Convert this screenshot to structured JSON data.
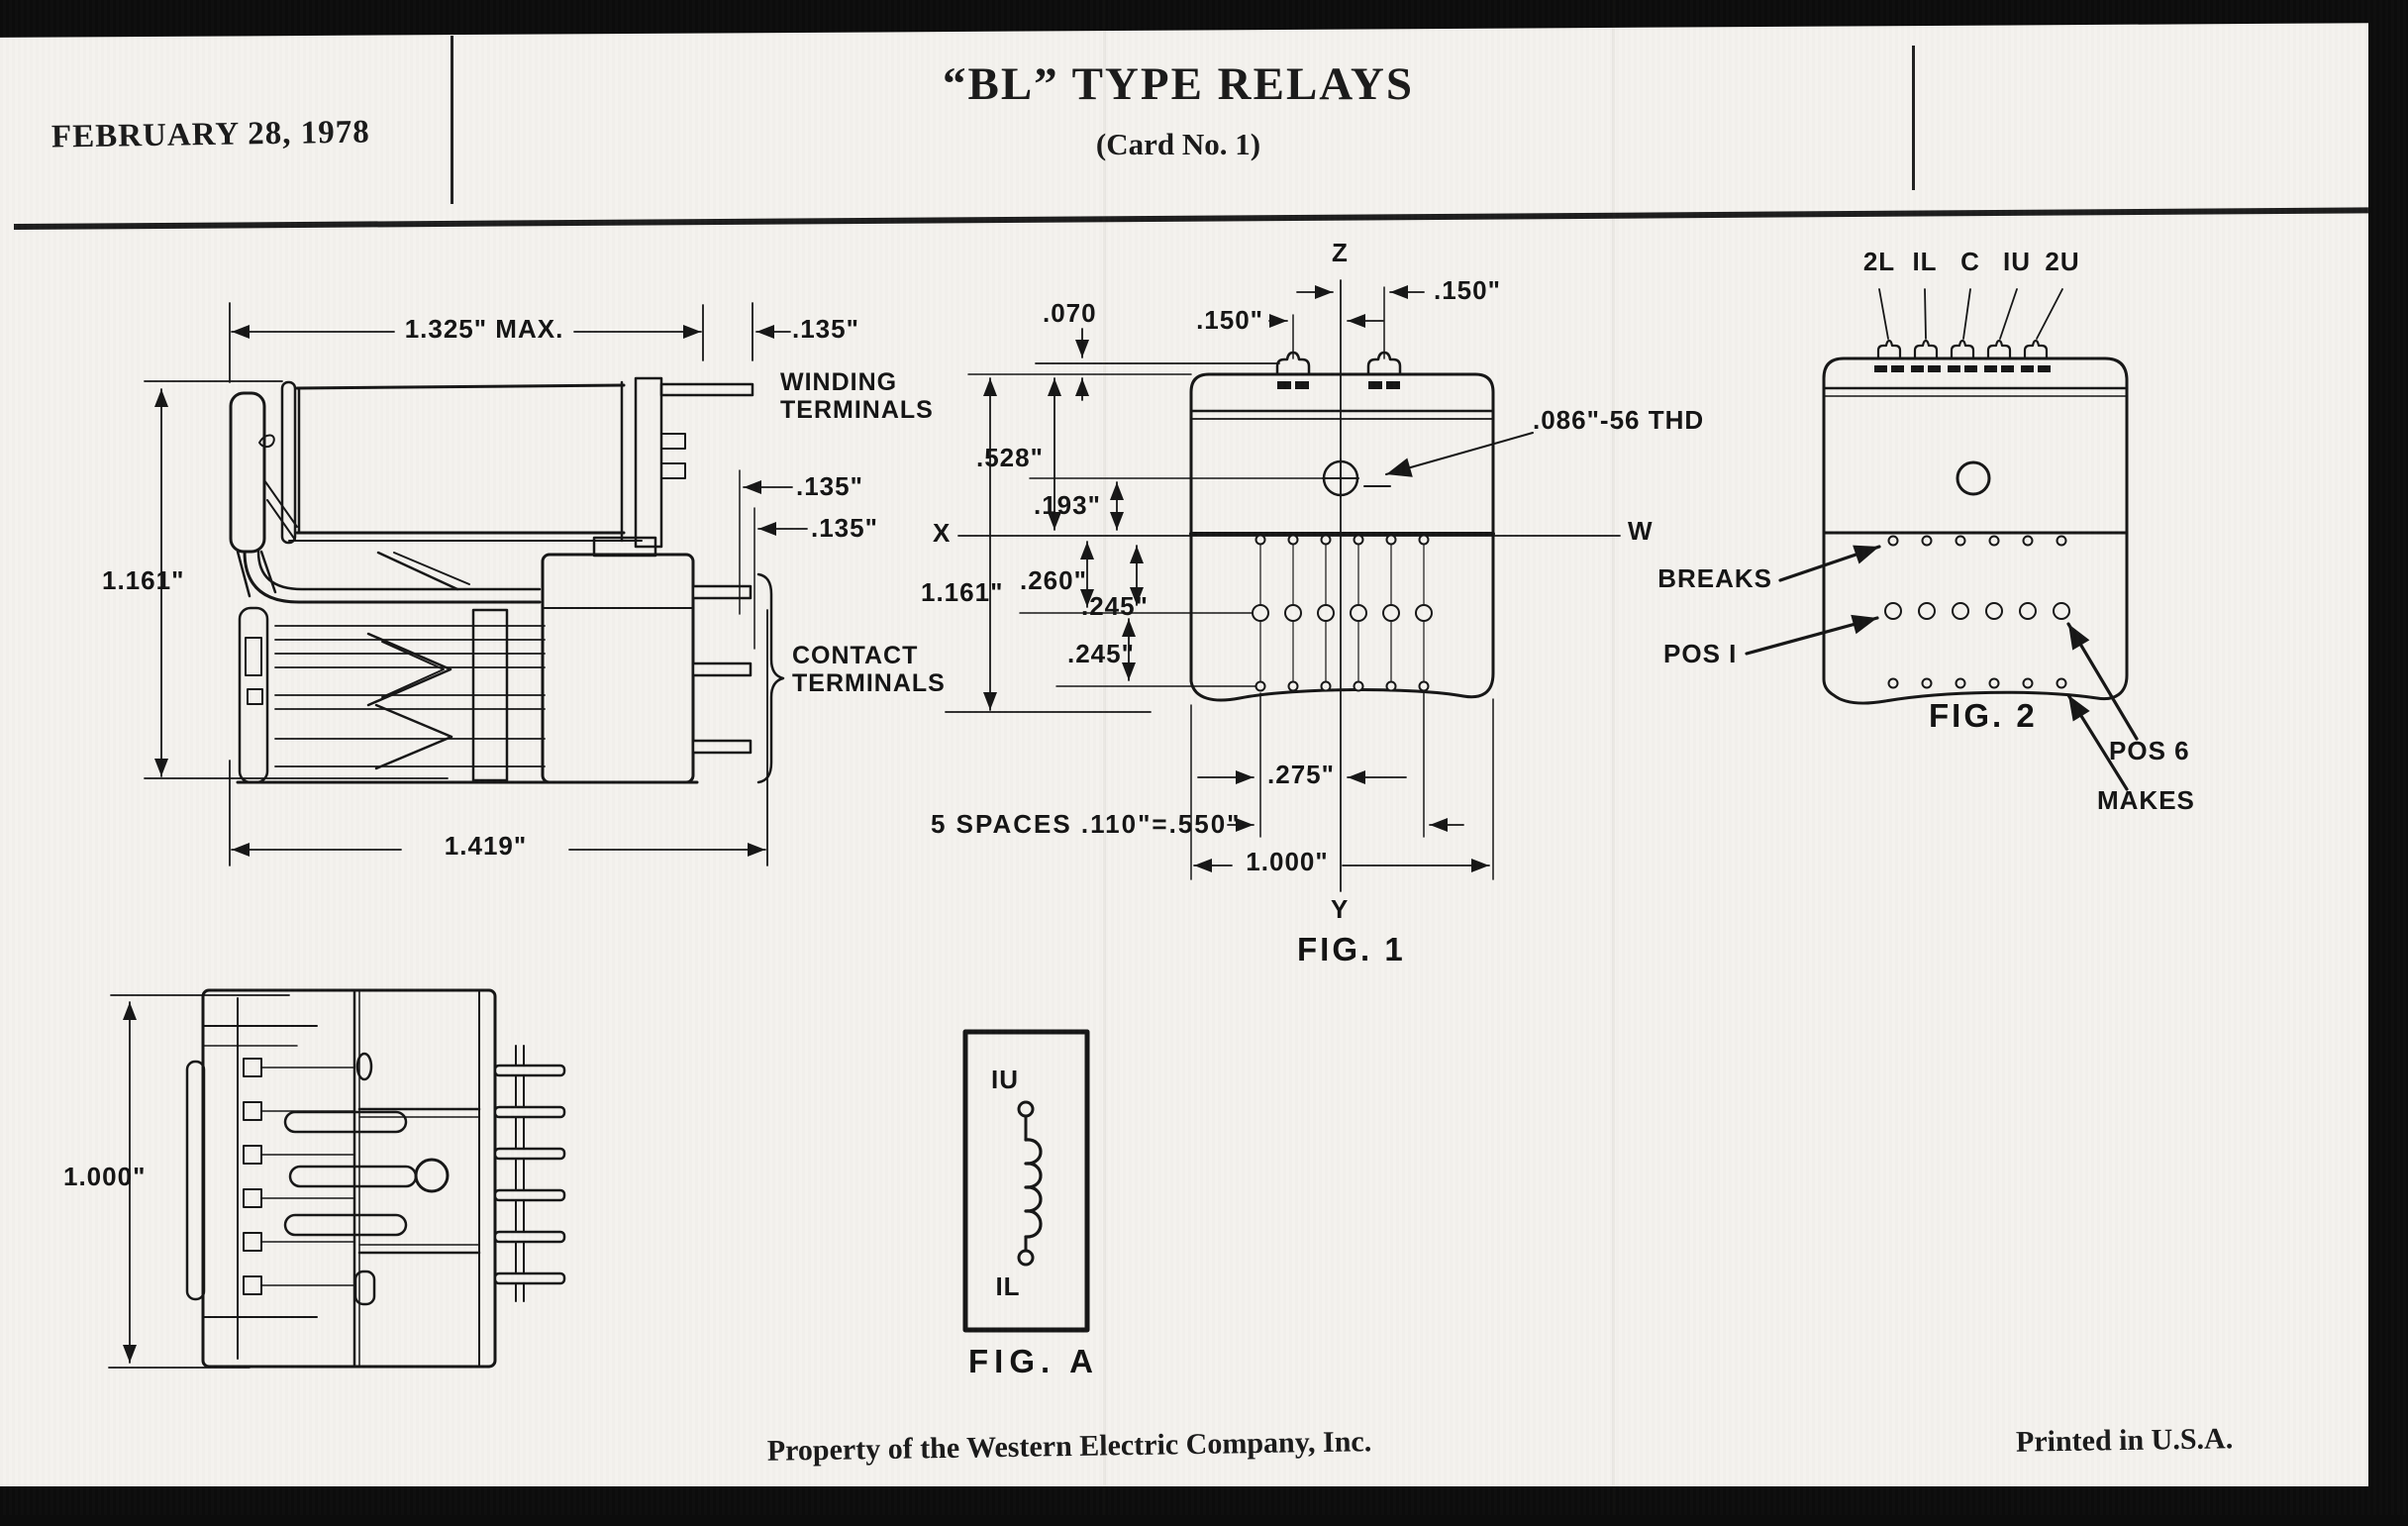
{
  "header": {
    "date": "FEBRUARY 28, 1978",
    "title": "“BL” TYPE RELAYS",
    "subtitle": "(Card No. 1)"
  },
  "side_view": {
    "dim_width_max": "1.325\" MAX.",
    "dim_tip_offset": ".135\"",
    "winding_terminals_label": "WINDING TERMINALS",
    "dim_pin_offset_upper": ".135\"",
    "dim_pin_offset_lower": ".135\"",
    "dim_height": "1.161\"",
    "contact_terminals_label": "CONTACT TERMINALS",
    "dim_overall_length": "1.419\""
  },
  "fig1": {
    "caption": "FIG. 1",
    "axis_z": "Z",
    "axis_x": "X",
    "axis_y": "Y",
    "axis_w": "W",
    "dim_tab_drop": ".070",
    "dim_slot_left": ".150\"",
    "dim_slot_right": ".150\"",
    "dim_screw_from_top": ".528\"",
    "dim_screw_to_x": ".193\"",
    "dim_height": "1.161\"",
    "dim_x_to_row2": ".260\"",
    "dim_row1_to_row2": ".245\"",
    "dim_row2_to_row3": ".245\"",
    "thread_spec": ".086\"-56 THD",
    "dim_row_offset": ".275\"",
    "spaces_note": "5 SPACES .110\"=.550\"",
    "dim_width": "1.000\""
  },
  "fig2": {
    "caption": "FIG. 2",
    "terminals": [
      "2L",
      "IL",
      "C",
      "IU",
      "2U"
    ],
    "breaks_label": "BREAKS",
    "pos1_label": "POS I",
    "pos6_label": "POS 6",
    "makes_label": "MAKES"
  },
  "top_view": {
    "dim_height": "1.000\""
  },
  "figA": {
    "caption": "FIG. A",
    "terminal_top": "IU",
    "terminal_bottom": "IL"
  },
  "footer": {
    "property_note": "Property of the Western Electric Company, Inc.",
    "printed_note": "Printed in U.S.A."
  }
}
